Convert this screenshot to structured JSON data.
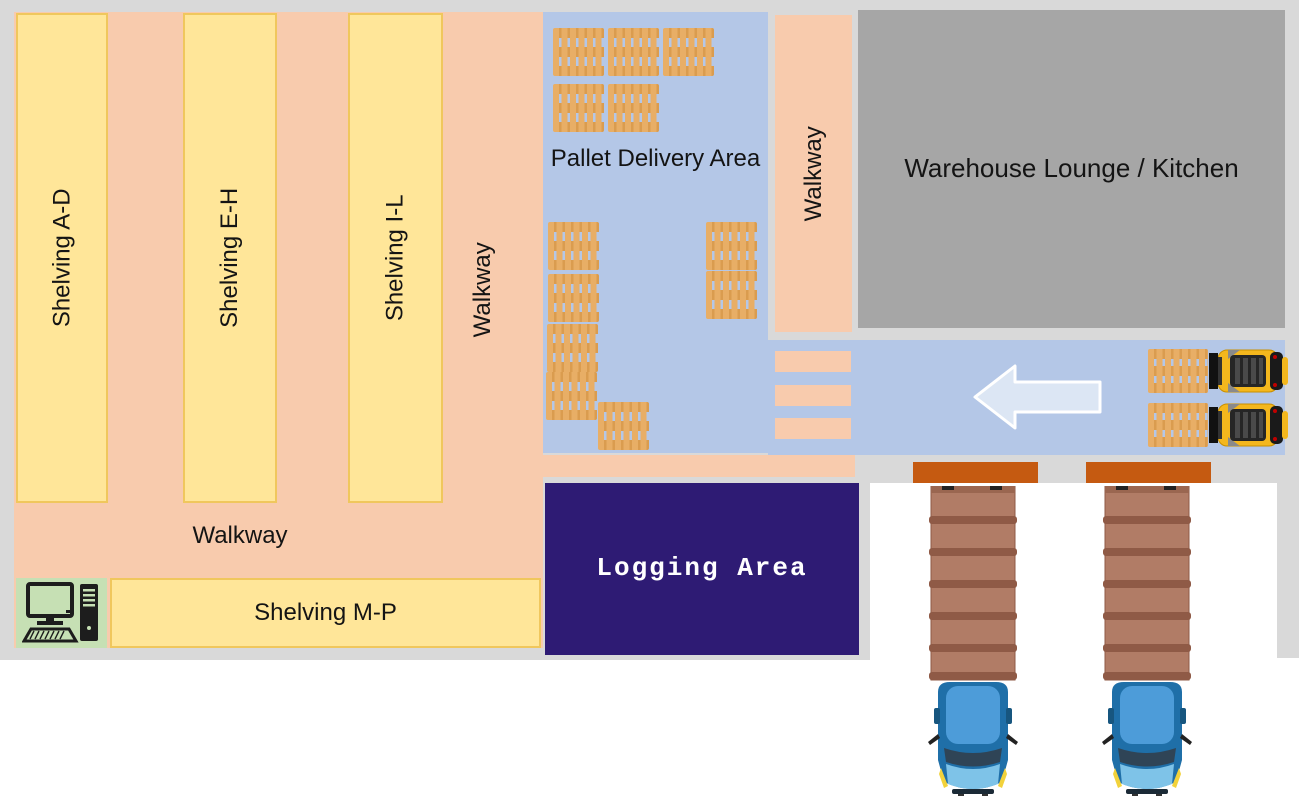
{
  "areas": {
    "shelving_ad": {
      "label": "Shelving A-D"
    },
    "shelving_eh": {
      "label": "Shelving E-H"
    },
    "shelving_il": {
      "label": "Shelving I-L"
    },
    "shelving_mp": {
      "label": "Shelving M-P"
    },
    "walkway_left": {
      "label": "Walkway"
    },
    "walkway_right": {
      "label": "Walkway"
    },
    "walkway_bottom": {
      "label": "Walkway"
    },
    "pallet_delivery": {
      "label": "Pallet Delivery Area"
    },
    "lounge": {
      "label": "Warehouse Lounge / Kitchen"
    },
    "logging": {
      "label": "Logging Area"
    }
  },
  "colors": {
    "frame": "#D9D9D9",
    "walkway": "#F8CBAD",
    "shelving": "#FFE699",
    "pallet_zone": "#B4C7E7",
    "lounge": "#A6A6A6",
    "logging": "#2E1B74",
    "dock": "#C55A11",
    "computer_station": "#C6E0B4",
    "arrow_fill": "#DCE6F4",
    "pallet_wood": "#E8AE66",
    "trailer": "#B17C66",
    "cab": "#1F6FA8",
    "forklift": "#F4B71D"
  },
  "icons": {
    "pallet": "wooden-pallet-icon",
    "forklift": "forklift-icon",
    "truck": "truck-icon",
    "computer": "computer-workstation-icon",
    "flow_arrow": "left-arrow-icon"
  },
  "counts": {
    "delivery_area_pallets": 12,
    "forklift_pallets": 2,
    "forklifts": 2,
    "trucks": 2,
    "dock_doors": 2,
    "crosswalk_bars": 3
  },
  "pallet_positions": [
    [
      553,
      28
    ],
    [
      608,
      28
    ],
    [
      663,
      28
    ],
    [
      553,
      84
    ],
    [
      608,
      84
    ],
    [
      548,
      222
    ],
    [
      548,
      274
    ],
    [
      547,
      324
    ],
    [
      546,
      372
    ],
    [
      598,
      402
    ],
    [
      706,
      222
    ],
    [
      706,
      271
    ]
  ]
}
